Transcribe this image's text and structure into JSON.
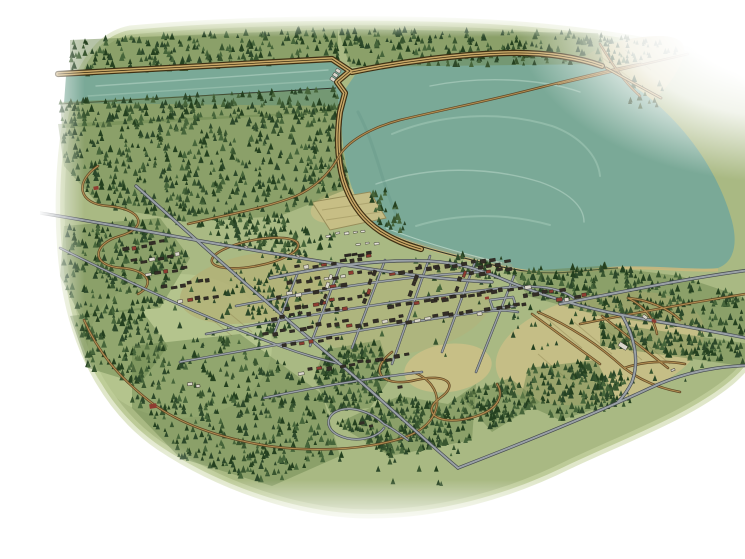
{
  "title": "Illustrated bird's-eye map of a lakeside town",
  "description": "Hand-drawn aerial illustration: a large teal reservoir lake at top right, a long spillway channel behind a dam embankment at top left with three spillway gates, a breakwater jetty on the north shore, dense evergreen forests, a small town street grid with tiny buildings at center, a railroad with a train, an oval track, winding brown trails, farm fields to the southeast, and watercolor edges fading to white.",
  "colors": {
    "paper": "#ffffff",
    "land_base": "#a9b983",
    "land_edge": "#ccd7a6",
    "meadow_light": "#bfcf97",
    "field_tan": "#c8bf86",
    "field_olive": "#b3b277",
    "field_line": "#958b58",
    "forest_under": "#6d8750",
    "forest_palette": [
      "#2c482a",
      "#38552f",
      "#46653a",
      "#24401f"
    ],
    "water": "#7aa997",
    "water_light": "#a7cdbb",
    "water_deep": "#5f9384",
    "water_pale": "#c6e0d2",
    "shallow_tan": "#bfa87e",
    "shoreline": "#2f3327",
    "beach_tan": "#cdb97d",
    "road_casing": "#43484d",
    "road_fill": "#9aa1a7",
    "trail_casing": "#5d4726",
    "trail_fill": "#b28e52",
    "dike_casing": "#3e3014",
    "dike_fill": "#c8a868",
    "building_dark": "#322d26",
    "building_red": "#8e3c31",
    "building_light": "#d9d6cb",
    "vehicle_light": "#e2e0d6",
    "train_dark": "#2a2622"
  },
  "features": [
    {
      "name": "reservoir-lake",
      "kind": "water"
    },
    {
      "name": "spillway-channel",
      "kind": "water"
    },
    {
      "name": "dam-embankment",
      "kind": "levee"
    },
    {
      "name": "spillway-gates",
      "kind": "structure"
    },
    {
      "name": "breakwater-jetty",
      "kind": "structure"
    },
    {
      "name": "town-street-grid",
      "kind": "roads"
    },
    {
      "name": "railroad-with-train",
      "kind": "rail"
    },
    {
      "name": "oval-track",
      "kind": "trail"
    },
    {
      "name": "evergreen-forest-stands",
      "kind": "vegetation"
    },
    {
      "name": "farm-fields",
      "kind": "land"
    },
    {
      "name": "winding-trails",
      "kind": "trail"
    },
    {
      "name": "scattered-buildings",
      "kind": "buildings"
    }
  ]
}
